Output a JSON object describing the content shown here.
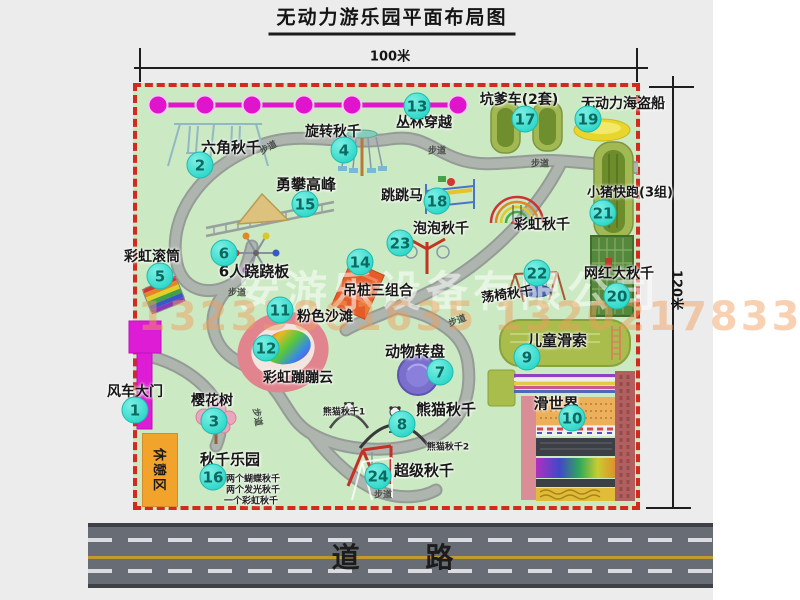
{
  "title": "无动力游乐园平面布局图",
  "dimensions": {
    "width": "100米",
    "height": "120米"
  },
  "road_label": "道 路",
  "path_label": "步道",
  "rest_area_label": "休憩区",
  "watermark": {
    "company": "安游乐设备有限公司",
    "phone": "13233861635 13202178333"
  },
  "attractions": [
    {
      "id": "1",
      "name": "风车大门"
    },
    {
      "id": "2",
      "name": "六角秋千"
    },
    {
      "id": "3",
      "name": "樱花树"
    },
    {
      "id": "4",
      "name": "旋转秋千"
    },
    {
      "id": "5",
      "name": "彩虹滚筒"
    },
    {
      "id": "6",
      "name": "6人跷跷板"
    },
    {
      "id": "7",
      "name": "动物转盘"
    },
    {
      "id": "8",
      "name": "熊猫秋千"
    },
    {
      "id": "9",
      "name": "儿童滑索"
    },
    {
      "id": "10",
      "name": "滑世界"
    },
    {
      "id": "11",
      "name": "粉色沙滩"
    },
    {
      "id": "12",
      "name": "彩虹蹦蹦云"
    },
    {
      "id": "13",
      "name": "丛林穿越"
    },
    {
      "id": "14",
      "name": "吊桩三组合"
    },
    {
      "id": "15",
      "name": "勇攀高峰"
    },
    {
      "id": "16",
      "name": "秋千乐园"
    },
    {
      "id": "17",
      "name": "坑爹车(2套)"
    },
    {
      "id": "18",
      "name": "跳跳马"
    },
    {
      "id": "19",
      "name": "无动力海盗船"
    },
    {
      "id": "20",
      "name": "网红大秋千"
    },
    {
      "id": "21",
      "name": "小猪快跑(3组)"
    },
    {
      "id": "22",
      "name": "荡椅秋千"
    },
    {
      "id": "23",
      "name": "泡泡秋千"
    },
    {
      "id": "24",
      "name": "超级秋千"
    }
  ],
  "extra_labels": {
    "rainbow_swing": "彩虹秋千",
    "panda_swing_1": "熊猫秋千1",
    "panda_swing_2": "熊猫秋千2"
  },
  "swing_park_notes": [
    "两个蝴蝶秋千",
    "两个发光秋千",
    "一个彩虹秋千"
  ],
  "colors": {
    "background": "#ececec",
    "park_fill": "#cbe9c2",
    "border_red": "#d3291e",
    "path_gray": "#aeb4ae",
    "badge": "#2fd8ca",
    "badge_text": "#0a6a62",
    "magenta_line": "#e016ce",
    "road_gray": "#686c74",
    "road_yellow": "#c09a30",
    "rest_area_orange": "#f2a32c"
  }
}
